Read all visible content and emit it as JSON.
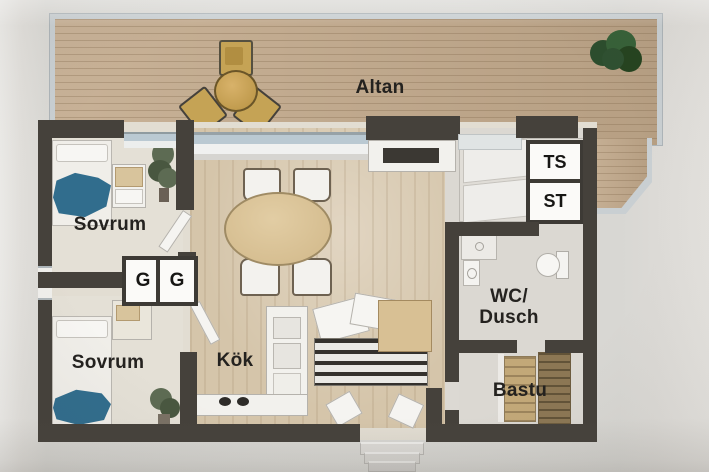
{
  "type": "floor-plan-photo",
  "rooms": {
    "altan": {
      "label": "Altan"
    },
    "sovrum_top": {
      "label": "Sovrum"
    },
    "sovrum_bottom": {
      "label": "Sovrum"
    },
    "kok": {
      "label": "Kök"
    },
    "wc_dusch": {
      "line1": "WC/",
      "line2": "Dusch"
    },
    "bastu": {
      "label": "Bastu"
    }
  },
  "closets": {
    "ts": {
      "label": "TS"
    },
    "st": {
      "label": "ST"
    },
    "g_left": {
      "label": "G"
    },
    "g_right": {
      "label": "G"
    }
  },
  "colors": {
    "wall": "#45413b",
    "deck_wood": "#c3a98a",
    "deck_railing": "#c9cfd2",
    "interior_floor": "#e2ddd2",
    "living_floor_wood": "#d6c5a9",
    "bed_blanket_blue": "#2f6d8f",
    "plant_green": "#2e5030",
    "sauna_bench": "#c3a876",
    "label_text": "#24221f",
    "paper_background": "#d9d8d4"
  }
}
